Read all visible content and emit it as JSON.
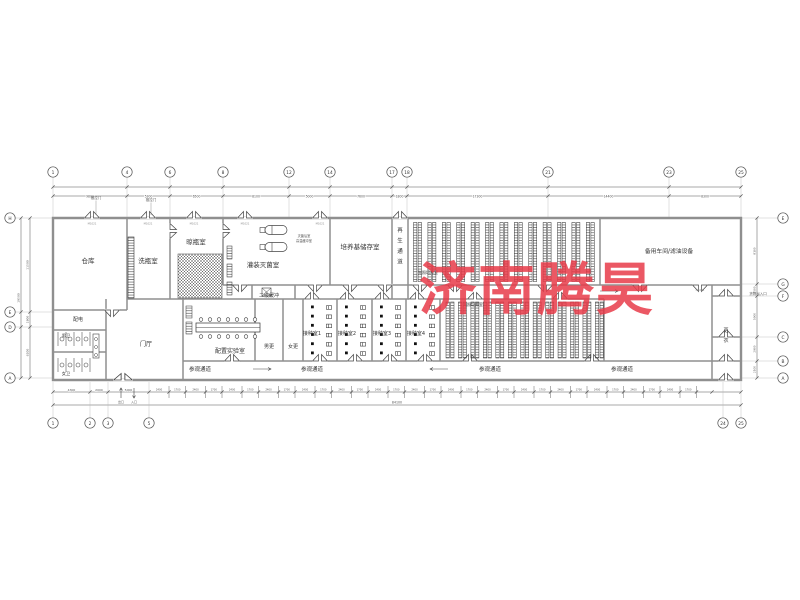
{
  "title": "车间平面图",
  "watermark": {
    "text": "济南腾昊",
    "color": "#e83b49"
  },
  "rooms": {
    "cangku": "仓库",
    "xiping": "洗瓶室",
    "liangping": "晾瓶室",
    "guanzhuang": "灌装灭菌室",
    "peiyangji": "培养基储存室",
    "zaisheng": "再生通道",
    "guangzhao1": "光照培养室",
    "guangzhao2": "光照培养室",
    "beiyong": "备用车间/滤油设备",
    "erji": "二级缓冲",
    "peizhi": "配置实验室",
    "nangeng": "男更",
    "nvgeng": "女更",
    "jiezhong1": "接种室1",
    "jiezhong2": "接种室2",
    "jiezhong3": "接种室3",
    "jiezhong4": "接种室4",
    "canguan": "参观通道",
    "peidian": "配电",
    "nanwei": "男卫",
    "nvwei": "女卫",
    "menting": "门厅",
    "gengyi": "更衣"
  },
  "annotations": {
    "tuilamen": "推拉门",
    "huowu": "货物出入口",
    "miejun": "灭菌后室",
    "gaowen": "高温缓冲室",
    "chukou": "出口",
    "rukou": "入口",
    "door_tag": "M1021"
  },
  "grid": {
    "top": [
      "1",
      "4",
      "6",
      "8",
      "12",
      "14",
      "17",
      "18",
      "21",
      "23",
      "25"
    ],
    "bottom": [
      "1",
      "2",
      "3",
      "5",
      "24",
      "25"
    ],
    "left": [
      "H",
      "E",
      "D",
      "A"
    ],
    "right": [
      "E",
      "G",
      "F",
      "C",
      "B",
      "A"
    ]
  },
  "dimensions": {
    "top": [
      "9800",
      "5300",
      "6500",
      "8100",
      "5000",
      "7600",
      "1800",
      "17300",
      "14400",
      "8300"
    ],
    "bottom_left": [
      "4300",
      "2000",
      "5000"
    ],
    "bottom_total": "84100",
    "left": [
      "11500",
      "1800",
      "6200"
    ],
    "left_total": "19500",
    "right": [
      "8100",
      "1500",
      "5000",
      "2900",
      "2100"
    ],
    "repeat": [
      "2400",
      "1700"
    ]
  }
}
